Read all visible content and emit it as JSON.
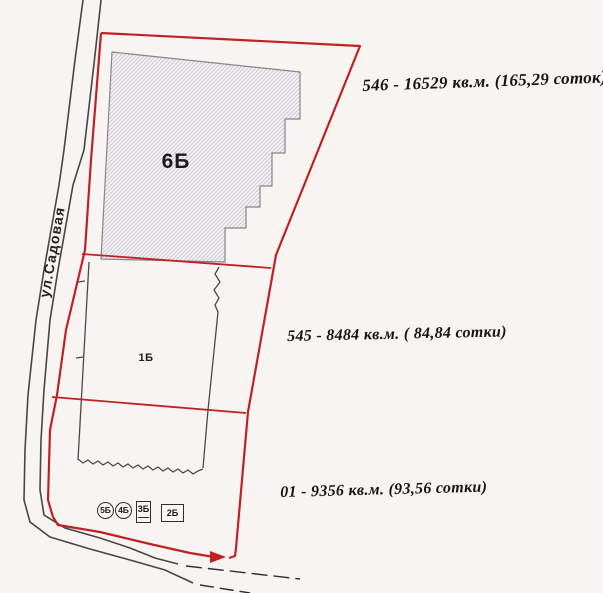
{
  "map": {
    "street": {
      "label": "ул.Садовая"
    },
    "plot_labels": {
      "b6": "6Б",
      "b1": "1Б"
    },
    "building_markers": [
      {
        "label": "5Б",
        "shape": "circle"
      },
      {
        "label": "4Б",
        "shape": "circle"
      },
      {
        "label": "3Б",
        "shape": "box"
      },
      {
        "label": "2Б",
        "shape": "box"
      }
    ],
    "area_annotations": [
      {
        "id": "546",
        "text": "546 - 16529 кв.м. (165,29 соток)"
      },
      {
        "id": "545",
        "text": "545 - 8484 кв.м. ( 84,84 сотки)"
      },
      {
        "id": "01",
        "text": "01 - 9356 кв.м. (93,56 сотки)"
      }
    ],
    "colors": {
      "boundary_red": "#bf2125",
      "line_black": "#3f3f3f",
      "hatch_line": "#cdc9d3",
      "hatch_fill": "#f5f3f5",
      "paper_background": "#f7f4f2",
      "annotation_text": "#151515"
    }
  }
}
